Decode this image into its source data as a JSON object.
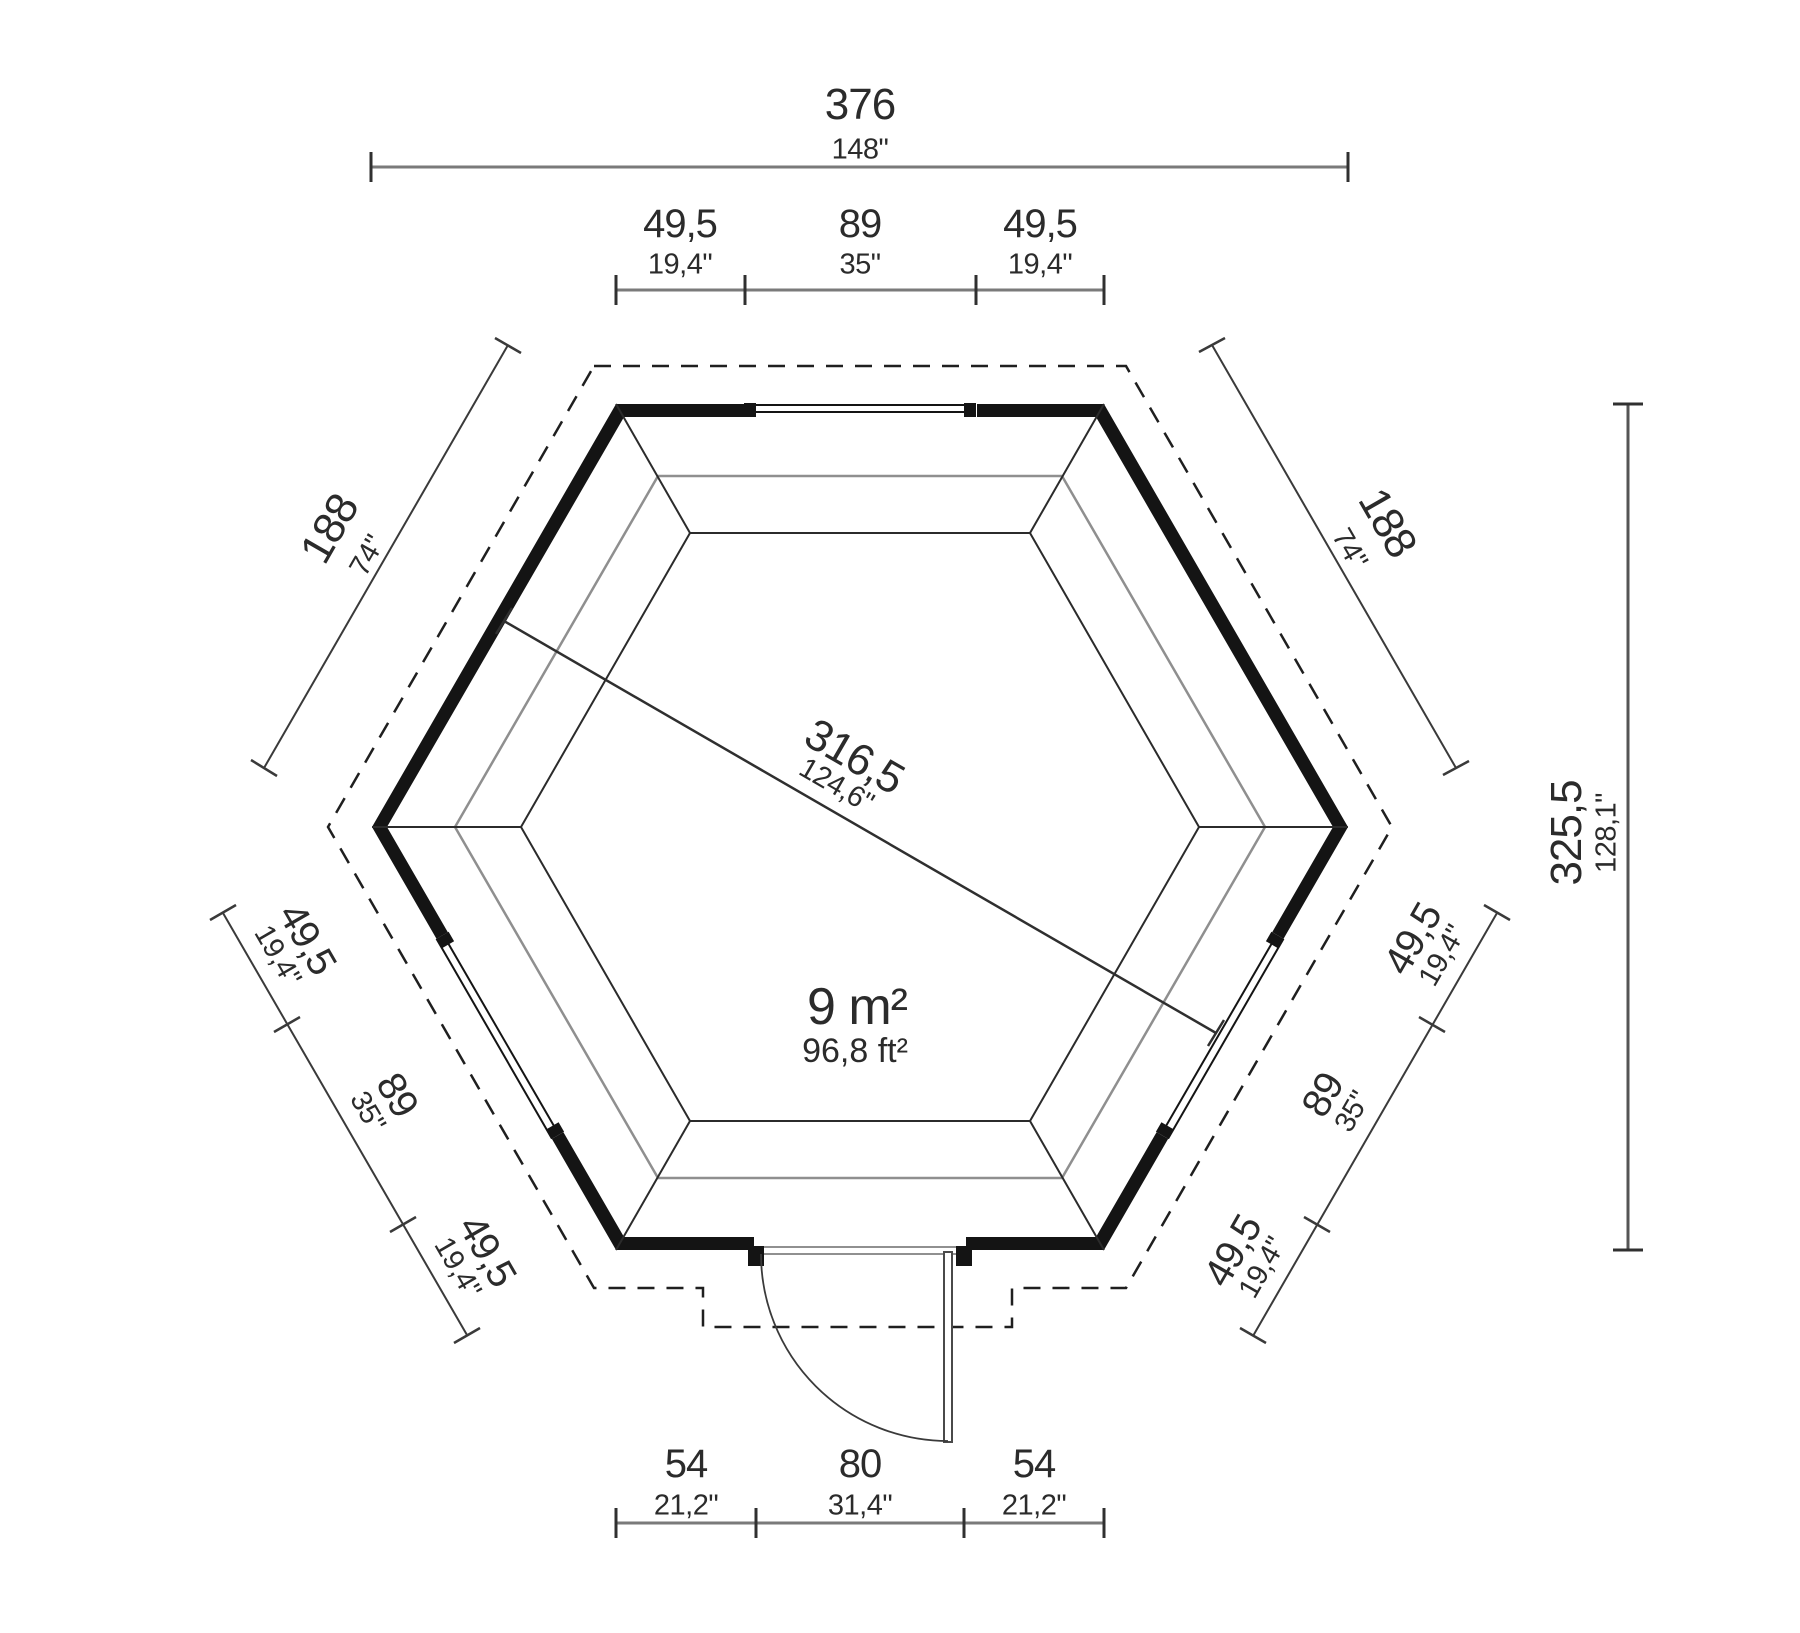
{
  "plan": {
    "area": {
      "m2": "9 m²",
      "ft2": "96,8 ft²"
    },
    "overall_width": {
      "cm": "376",
      "inch": "148\""
    },
    "overall_height": {
      "cm": "325,5",
      "inch": "128,1\""
    },
    "inner_diagonal": {
      "cm": "316,5",
      "inch": "124,6\""
    },
    "side_upper_left": {
      "cm": "188",
      "inch": "74\""
    },
    "side_upper_right": {
      "cm": "188",
      "inch": "74\""
    },
    "top_wall_segments": [
      {
        "cm": "49,5",
        "inch": "19,4\""
      },
      {
        "cm": "89",
        "inch": "35\""
      },
      {
        "cm": "49,5",
        "inch": "19,4\""
      }
    ],
    "lower_left_wall_segments": [
      {
        "cm": "49,5",
        "inch": "19,4\""
      },
      {
        "cm": "89",
        "inch": "35\""
      },
      {
        "cm": "49,5",
        "inch": "19,4\""
      }
    ],
    "lower_right_wall_segments": [
      {
        "cm": "49,5",
        "inch": "19,4\""
      },
      {
        "cm": "89",
        "inch": "35\""
      },
      {
        "cm": "49,5",
        "inch": "19,4\""
      }
    ],
    "bottom_wall_segments": [
      {
        "cm": "54",
        "inch": "21,2\""
      },
      {
        "cm": "80",
        "inch": "31,4\""
      },
      {
        "cm": "54",
        "inch": "21,2\""
      }
    ],
    "colors": {
      "ink": "#2b2b2b",
      "wall": "#141414",
      "dim_line_gray": "#7a7a7a",
      "tick_dark": "#303030",
      "floor_line_gray": "#8f8f8f"
    }
  }
}
